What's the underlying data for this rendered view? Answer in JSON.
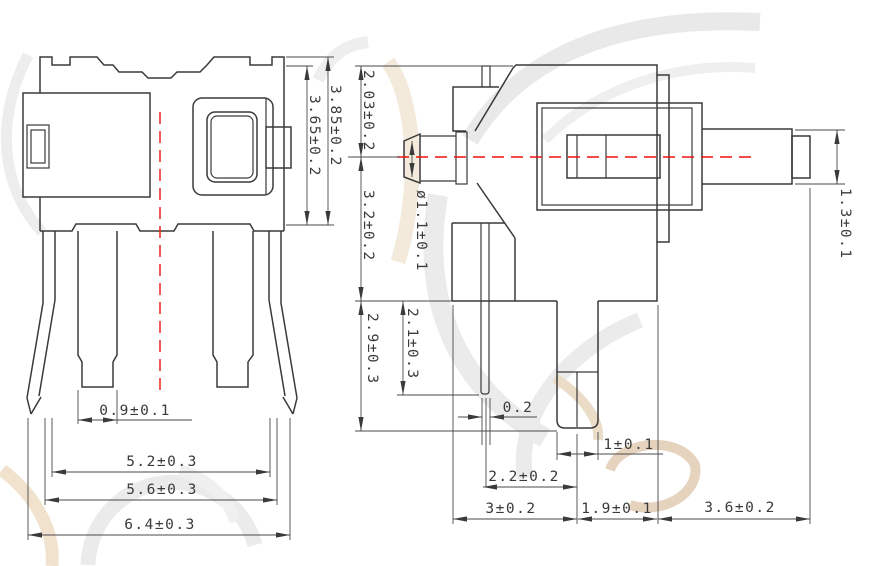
{
  "drawing": {
    "type": "switch-component-dimension-drawing",
    "colors": {
      "line": "#3a3a3a",
      "centerline": "#ee1111",
      "watermark_gray": "#d9d9d9",
      "watermark_tan": "#e4c79f"
    },
    "front_view": {
      "dims": {
        "pin_width": "0.9±0.1",
        "inner_span": "5.2±0.3",
        "outer_span": "5.6±0.3",
        "overall_width": "6.4±0.3",
        "body_height": "3.65±0.2",
        "overall_height": "3.85±0.2"
      }
    },
    "side_view": {
      "dims": {
        "upper_height": "2.03±0.2",
        "lower_height": "3.2±0.2",
        "boss_diameter": "ø1.1±0.1",
        "terminal_length": "2.1±0.3",
        "foot_length": "2.9±0.3",
        "terminal_thickness": "0.2",
        "foot_width": "1±0.1",
        "foot_offset": "2.2±0.2",
        "body_depth": "3±0.2",
        "step_depth": "1.9±0.1",
        "shaft_length": "3.6±0.2",
        "shaft_height": "1.3±0.1"
      }
    }
  }
}
